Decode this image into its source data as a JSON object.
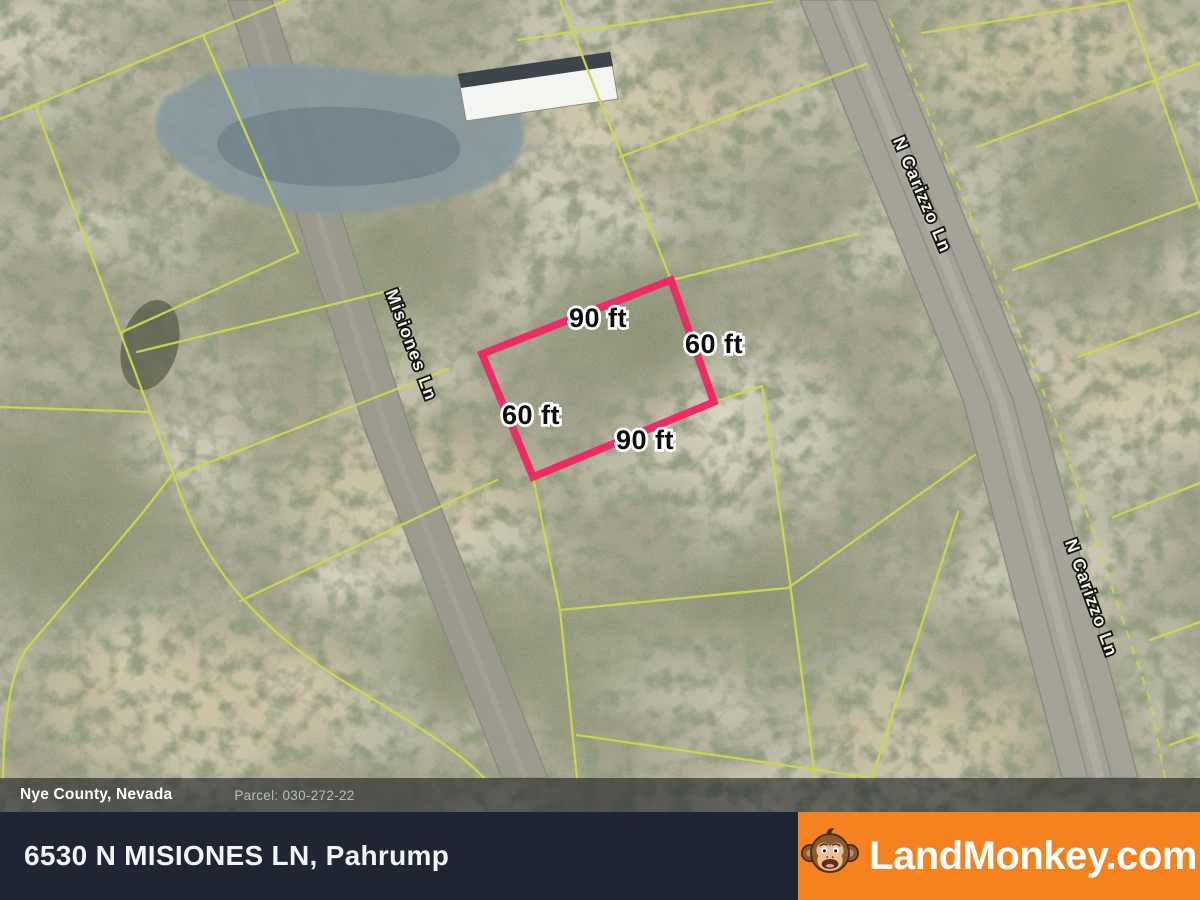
{
  "map": {
    "parcel": {
      "dim_top": "90 ft",
      "dim_right": "60 ft",
      "dim_left": "60 ft",
      "dim_bottom": "90 ft"
    },
    "road_labels": [
      "Misiones Ln",
      "N Carizzo Ln",
      "N Carizzo Ln"
    ],
    "colors": {
      "parcel_outline": "#ee2a67",
      "parcel_lines": "#ccd84e"
    }
  },
  "county_bar": {
    "county": "Nye County, Nevada",
    "parcel_id": "Parcel: 030-272-22"
  },
  "footer": {
    "address": "6530 N MISIONES LN, Pahrump",
    "brand": "LandMonkey.com",
    "brand_bg": "#f6821f"
  },
  "icons": {
    "brand_logo": "monkey-face-icon"
  }
}
